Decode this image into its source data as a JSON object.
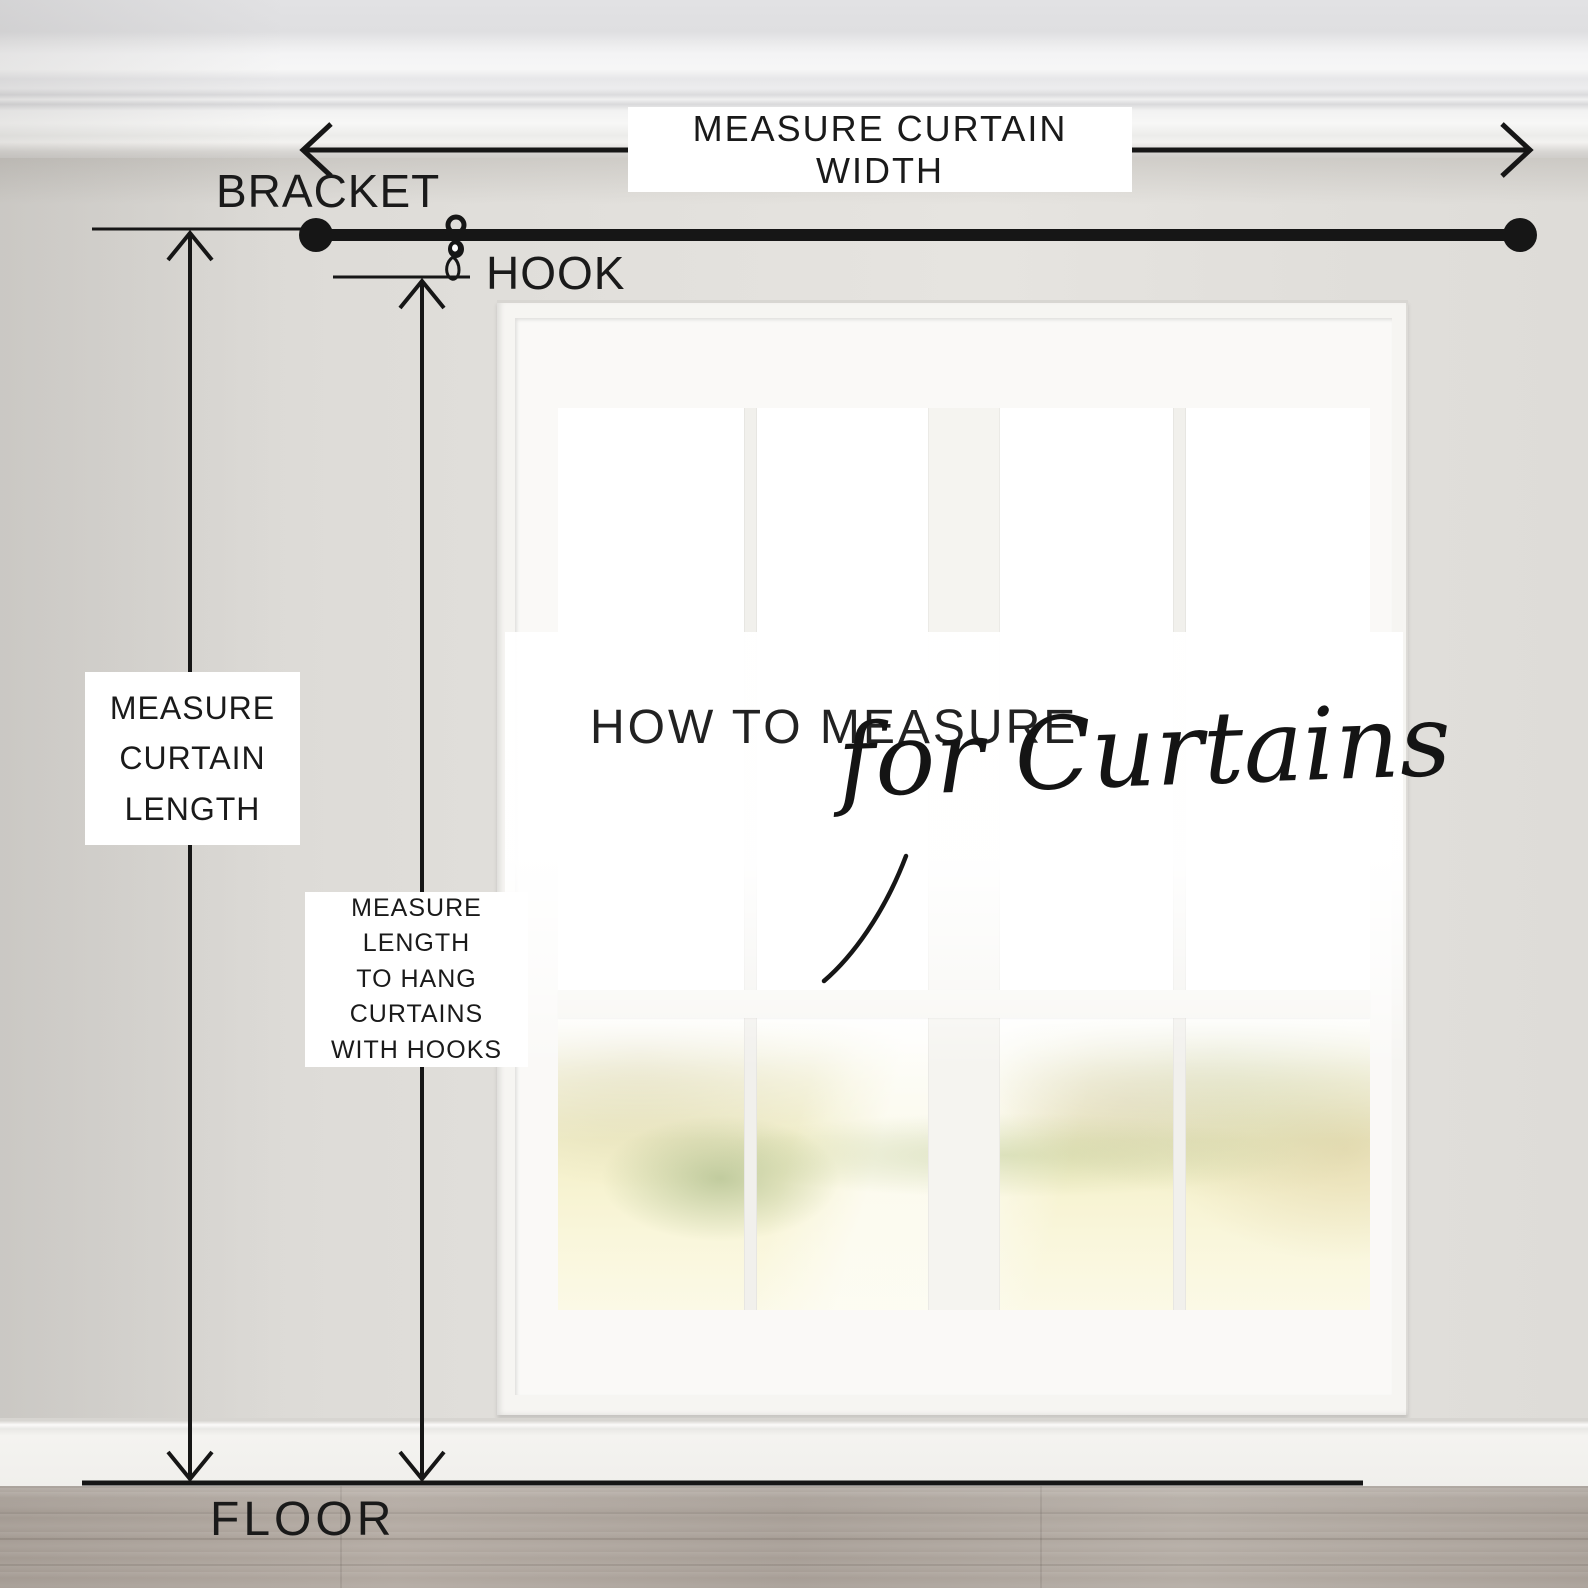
{
  "title": {
    "main": "HOW TO MEASURE",
    "script": "for Curtains"
  },
  "annotations": {
    "width_label": "MEASURE CURTAIN WIDTH",
    "bracket_label": "BRACKET",
    "hook_label": "HOOK",
    "floor_label": "FLOOR",
    "length_box": {
      "lines": [
        "MEASURE",
        "CURTAIN",
        "LENGTH"
      ]
    },
    "hook_length_box": {
      "lines": [
        "MEASURE",
        "LENGTH",
        "TO HANG",
        "CURTAINS",
        "WITH HOOKS"
      ]
    }
  },
  "icons": {
    "width_arrow": "double-headed-horizontal-arrow",
    "curtain_length_arrow": "double-headed-vertical-arrow",
    "hook_length_arrow": "double-headed-vertical-arrow",
    "curtain_rod": "rod-with-ball-finials",
    "hook": "curtain-ring-with-hook",
    "floor_line": "floor-reference-line"
  },
  "colors": {
    "annotation_ink": "#1a1a1a",
    "label_background": "#ffffff",
    "wall": "#dedcd8",
    "window_trim": "#f6f5f2",
    "floor_wood": "#a9a098"
  }
}
